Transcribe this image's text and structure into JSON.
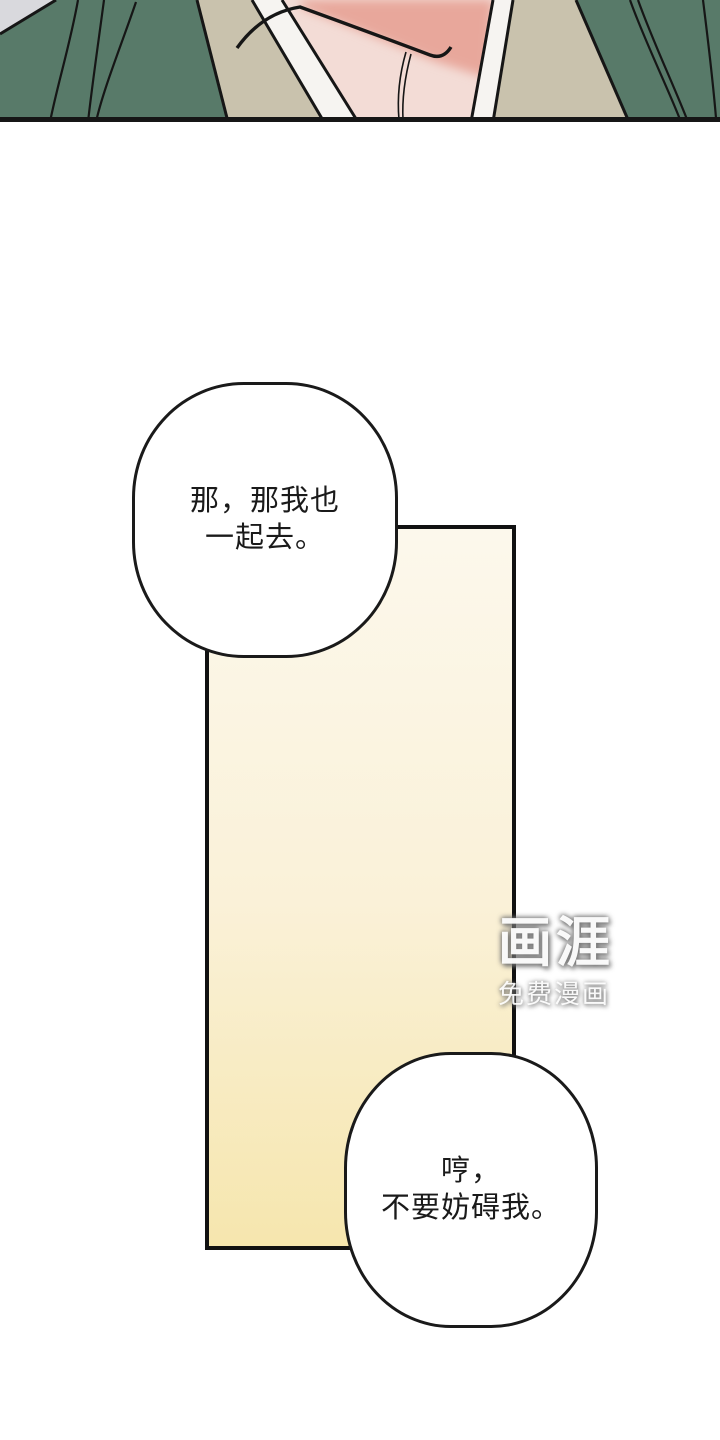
{
  "page": {
    "width": 720,
    "height": 1440
  },
  "colors": {
    "page-bg": "#ffffff",
    "robe-green": "#587a69",
    "under-robe-beige": "#c9c2ad",
    "collar-white": "#f6f4f1",
    "skin-light": "#f3dcd6",
    "skin-shadow": "#e8a79b",
    "corner-gray": "#d9d9dd",
    "line-black": "#161616",
    "panel-border": "#111111",
    "scroll-top": "#fcf8ec",
    "scroll-mid": "#faf1d8",
    "scroll-bottom": "#f6e6ae",
    "bubble-fill": "#ffffff",
    "bubble-border": "#1a1a1a",
    "text-black": "#1a1a1a"
  },
  "bubbles": [
    {
      "lines": [
        "那，那我也",
        "一起去。"
      ]
    },
    {
      "lines": [
        "哼，",
        "不要妨碍我。"
      ]
    }
  ],
  "watermark": {
    "logo": "画涯",
    "tagline": "免费漫画"
  }
}
